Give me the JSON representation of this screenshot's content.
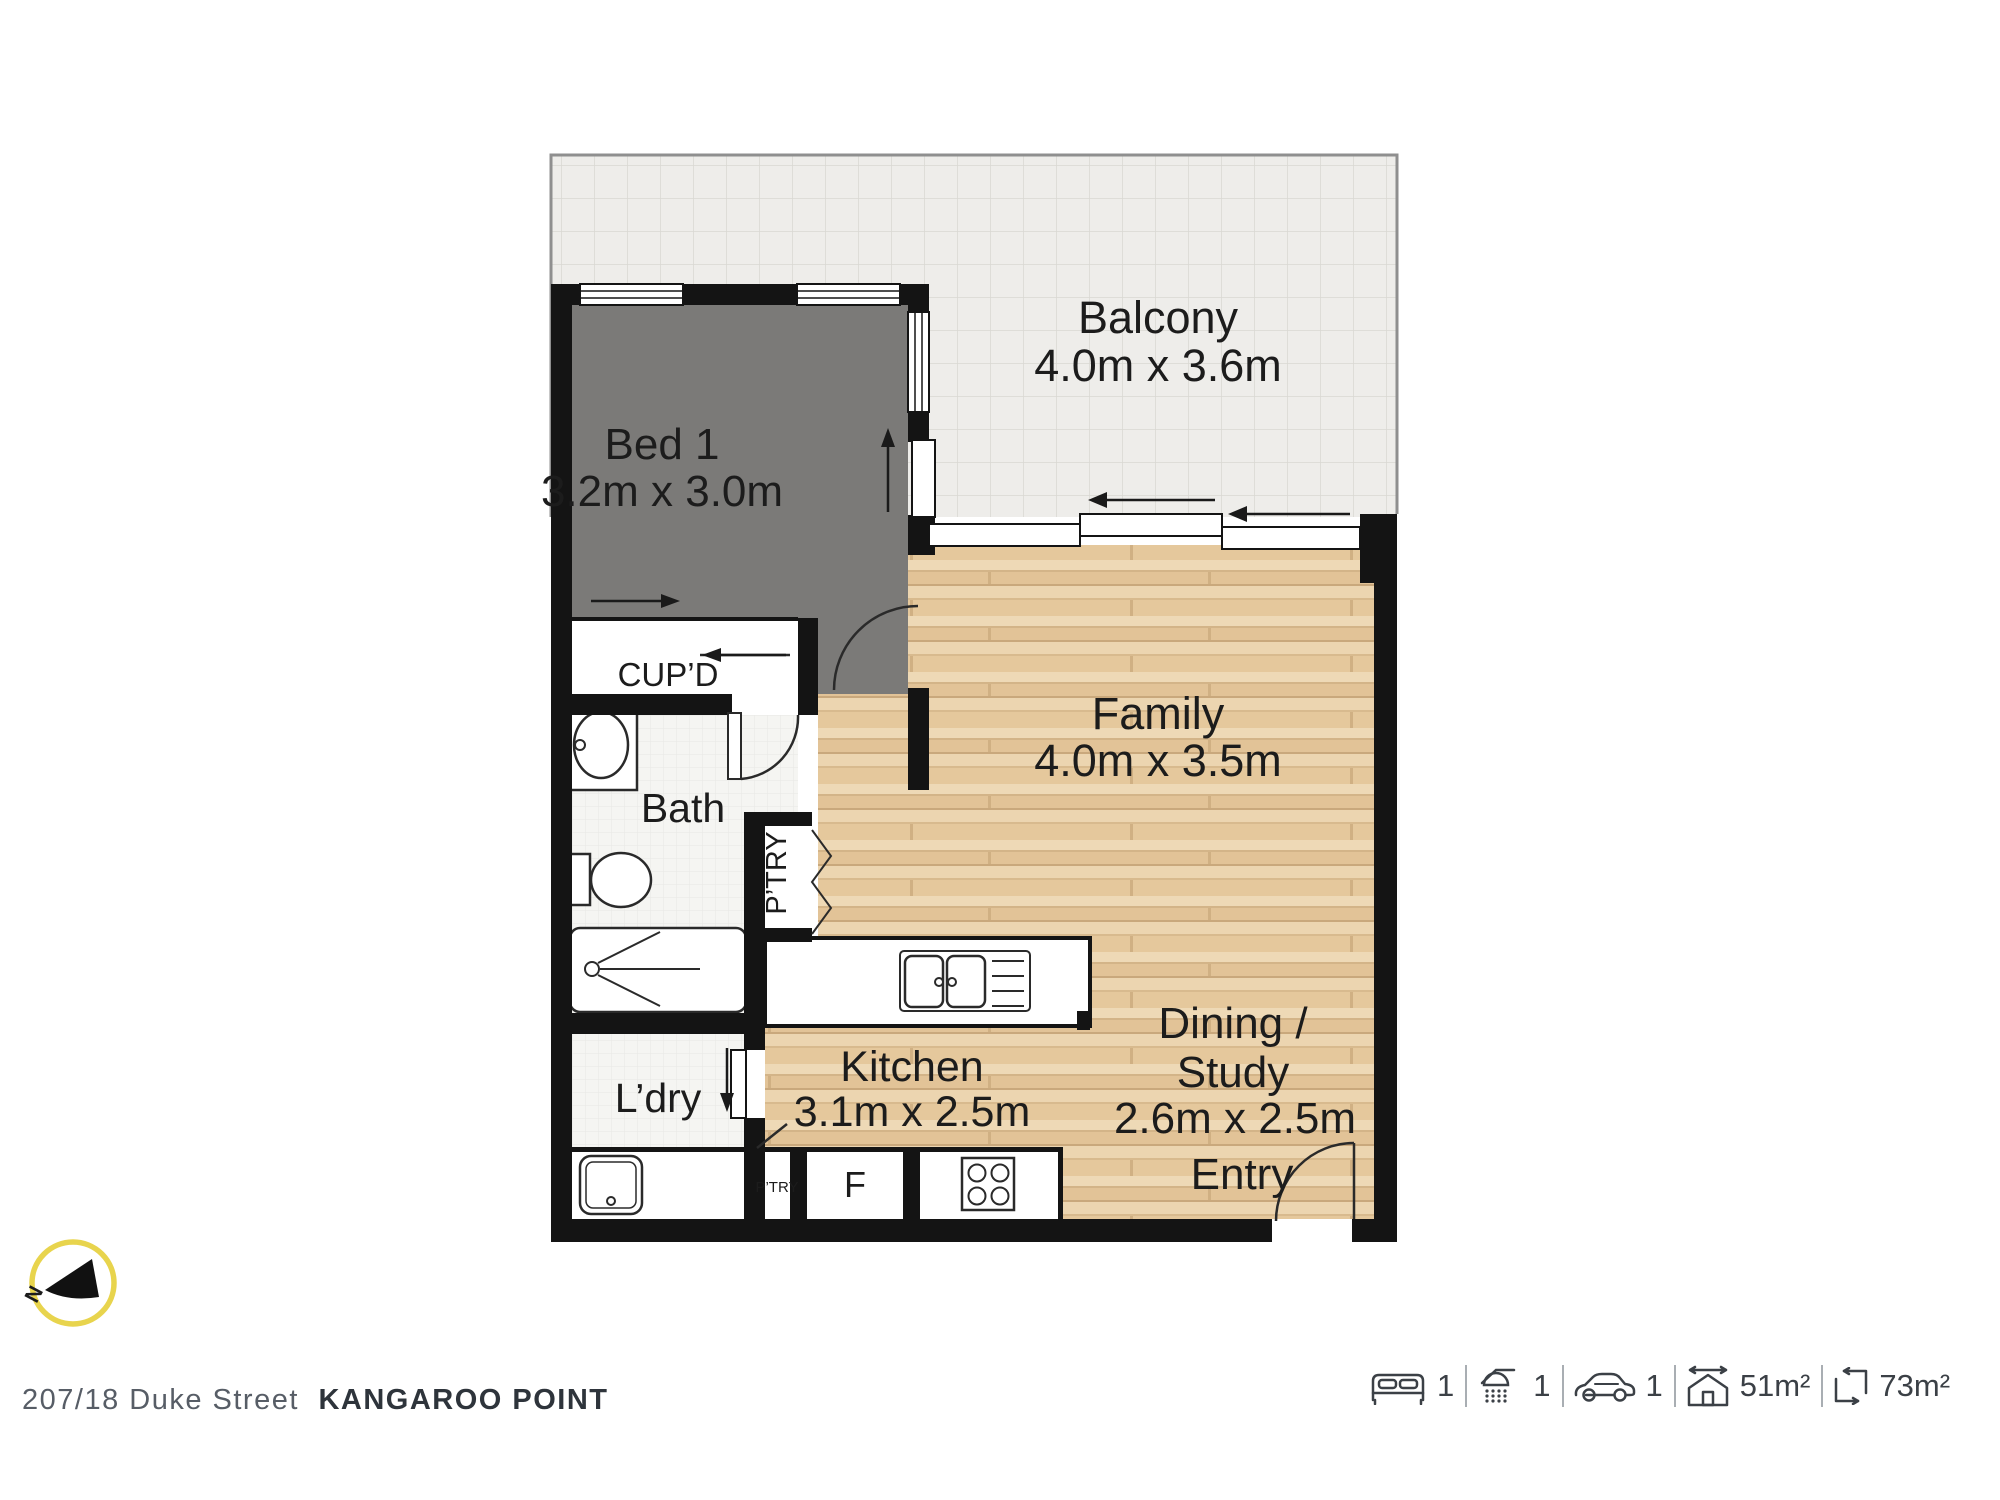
{
  "floorplan": {
    "rooms": {
      "balcony": {
        "name": "Balcony",
        "dims": "4.0m x 3.6m"
      },
      "bed1": {
        "name": "Bed 1",
        "dims": "3.2m x 3.0m"
      },
      "family": {
        "name": "Family",
        "dims": "4.0m x 3.5m"
      },
      "dining": {
        "line1": "Dining /",
        "line2": "Study",
        "dims": "2.6m x 2.5m"
      },
      "kitchen": {
        "name": "Kitchen",
        "dims": "3.1m x 2.5m"
      },
      "bath": {
        "name": "Bath"
      },
      "laundry": {
        "name": "L’dry"
      },
      "entry": {
        "name": "Entry"
      },
      "cupboard": {
        "name": "CUP’D"
      },
      "pantry": {
        "name": "P’TRY"
      },
      "pantry_small": {
        "name": "P’TRY"
      },
      "fridge": {
        "name": "F"
      }
    },
    "compass": {
      "north_label": "N"
    }
  },
  "footer": {
    "address": {
      "street": "207/18 Duke Street",
      "suburb": "KANGAROO POINT"
    },
    "stats": {
      "beds": "1",
      "showers": "1",
      "cars": "1",
      "internal_area": "51m²",
      "total_area": "73m²"
    }
  },
  "colors": {
    "wall": "#141414",
    "carpet": "#7b7a78",
    "balcony_tile": "#eeedea",
    "wood_base": "#e7cda4",
    "compass_ring": "#e8d44d",
    "footer_text": "#3b4046"
  }
}
